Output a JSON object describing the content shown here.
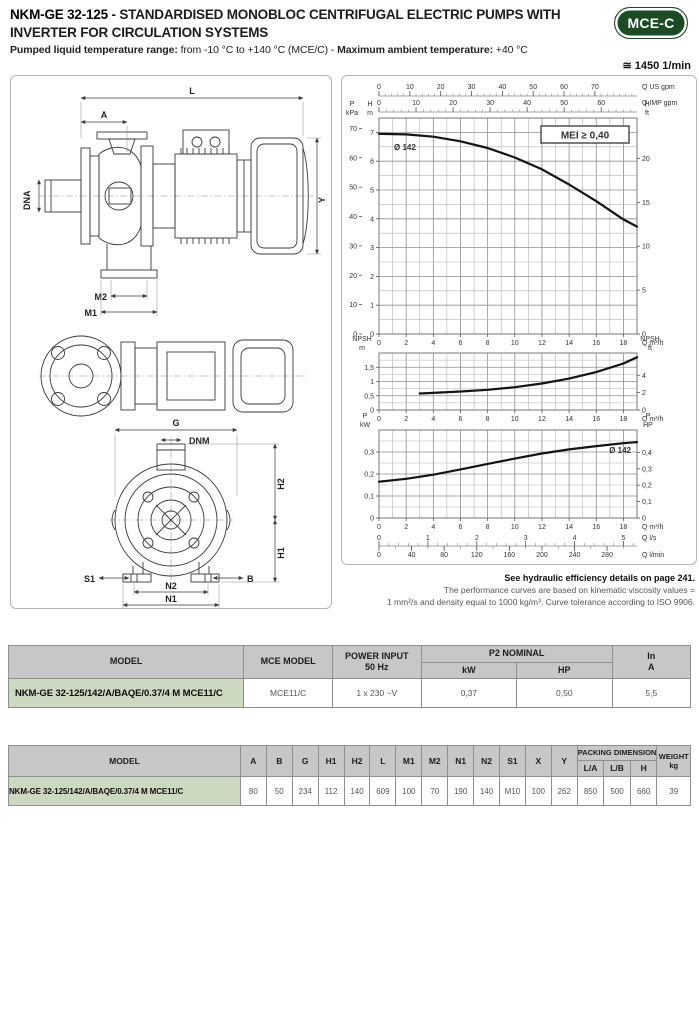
{
  "header": {
    "model": "NKM-GE 32-125",
    "title_sep": " - ",
    "title_rest": "STANDARDISED MONOBLOC CENTRIFUGAL ELECTRIC PUMPS WITH INVERTER FOR CIRCULATION SYSTEMS",
    "badge": "MCE-C",
    "subtitle_bold1": "Pumped liquid temperature range:",
    "subtitle_reg1": " from -10 °C to +140 °C (MCE/C) - ",
    "subtitle_bold2": "Maximum ambient temperature:",
    "subtitle_reg2": " +40 °C",
    "speed": "≅ 1450 1/min"
  },
  "drawing": {
    "labels": {
      "L": "L",
      "A": "A",
      "Y": "Y",
      "DNA": "DNA",
      "M2": "M2",
      "M1": "M1",
      "G": "G",
      "DNM": "DNM",
      "H2": "H2",
      "H1": "H1",
      "S1": "S1",
      "B": "B",
      "N2": "N2",
      "N1": "N1"
    }
  },
  "chart_data": [
    {
      "type": "line",
      "id": "head",
      "badge": "MEI ≥ 0,40",
      "curve_label": "Ø 142",
      "x_axis": {
        "unit": "Q m³/h",
        "min": 0,
        "max": 19,
        "minor_step": 1,
        "major_ticks": [
          0,
          2,
          4,
          6,
          8,
          10,
          12,
          14,
          16,
          18
        ]
      },
      "y_axis": {
        "corner": [
          "H",
          "m"
        ],
        "min": 0,
        "max": 7.5,
        "minor_step": 0.5,
        "major_ticks": [
          0,
          1,
          2,
          3,
          4,
          5,
          6,
          7
        ]
      },
      "left_scale2": {
        "corner": [
          "P",
          "kPa"
        ],
        "ticks": [
          0,
          10,
          20,
          30,
          40,
          50,
          60,
          70
        ],
        "to_primary": 0.10197
      },
      "right_scale": {
        "corner": [
          "H",
          "ft"
        ],
        "ticks": [
          0,
          5,
          10,
          15,
          20
        ],
        "to_primary": 0.3048
      },
      "top_scales": [
        {
          "title": "Q US gpm",
          "ticks": [
            0,
            10,
            20,
            30,
            40,
            50,
            60,
            70
          ],
          "minor_step": 2,
          "to_primary": 0.22712
        },
        {
          "title": "Q IMP gpm",
          "ticks": [
            0,
            10,
            20,
            30,
            40,
            50,
            60
          ],
          "minor_step": 2,
          "to_primary": 0.27276
        }
      ],
      "series": [
        {
          "name": "Ø 142",
          "points": [
            [
              0,
              6.95
            ],
            [
              2,
              6.93
            ],
            [
              4,
              6.85
            ],
            [
              6,
              6.69
            ],
            [
              8,
              6.46
            ],
            [
              10,
              6.13
            ],
            [
              12,
              5.72
            ],
            [
              14,
              5.19
            ],
            [
              16,
              4.61
            ],
            [
              18,
              3.98
            ],
            [
              19,
              3.73
            ]
          ]
        }
      ]
    },
    {
      "type": "line",
      "id": "npsh",
      "x_axis": {
        "unit": "Q m³/h",
        "min": 0,
        "max": 19,
        "minor_step": 1,
        "major_ticks": [
          0,
          2,
          4,
          6,
          8,
          10,
          12,
          14,
          16,
          18
        ]
      },
      "y_axis": {
        "corner": [
          "NPSH",
          "m"
        ],
        "min": 0,
        "max": 2,
        "minor_step": 0.25,
        "major_ticks": [
          0,
          0.5,
          1,
          1.5
        ]
      },
      "right_scale": {
        "corner": [
          "NPSH",
          "ft"
        ],
        "ticks": [
          0,
          2,
          4
        ],
        "to_primary": 0.3048
      },
      "series": [
        {
          "name": "NPSH",
          "points": [
            [
              3,
              0.58
            ],
            [
              4,
              0.6
            ],
            [
              6,
              0.65
            ],
            [
              8,
              0.71
            ],
            [
              10,
              0.8
            ],
            [
              12,
              0.93
            ],
            [
              14,
              1.1
            ],
            [
              16,
              1.33
            ],
            [
              18,
              1.63
            ],
            [
              19,
              1.85
            ]
          ]
        }
      ]
    },
    {
      "type": "line",
      "id": "power",
      "curve_label": "Ø 142",
      "x_axis": {
        "unit": "Q m³/h",
        "min": 0,
        "max": 19,
        "minor_step": 1,
        "major_ticks": [
          0,
          2,
          4,
          6,
          8,
          10,
          12,
          14,
          16,
          18
        ]
      },
      "y_axis": {
        "corner": [
          "P",
          "kW"
        ],
        "min": 0,
        "max": 0.4,
        "minor_step": 0.05,
        "major_ticks": [
          0,
          0.1,
          0.2,
          0.3
        ]
      },
      "right_scale": {
        "corner": [
          "P",
          "HP"
        ],
        "ticks": [
          0,
          0.1,
          0.2,
          0.3,
          0.4
        ],
        "to_primary": 0.7457
      },
      "bottom_scales": [
        {
          "title": "Q l/s",
          "ticks": [
            0,
            1,
            2,
            3,
            4,
            5
          ],
          "minor_step": 0.2,
          "to_primary": 3.6
        },
        {
          "title": "Q l/min",
          "ticks": [
            0,
            40,
            80,
            120,
            160,
            200,
            240,
            280
          ],
          "minor_step": 20,
          "to_primary": 0.06
        }
      ],
      "series": [
        {
          "name": "Ø 142",
          "points": [
            [
              0,
              0.165
            ],
            [
              2,
              0.178
            ],
            [
              4,
              0.197
            ],
            [
              6,
              0.221
            ],
            [
              8,
              0.246
            ],
            [
              10,
              0.27
            ],
            [
              12,
              0.293
            ],
            [
              14,
              0.312
            ],
            [
              16,
              0.327
            ],
            [
              18,
              0.34
            ],
            [
              19,
              0.345
            ]
          ]
        }
      ]
    }
  ],
  "notes": {
    "bold": "See hydraulic efficiency details on page 241.",
    "line1": "The performance curves are based on kinematic viscosity values =",
    "line2": "1 mm²/s and density equal to 1000 kg/m³. Curve tolerance according to ISO 9906."
  },
  "table1": {
    "headers": {
      "model": "MODEL",
      "mce_model": "MCE MODEL",
      "power_input": "POWER INPUT",
      "power_input_sub": "50 Hz",
      "p2_nominal": "P2 NOMINAL",
      "kw": "kW",
      "hp": "HP",
      "in_label": "In",
      "in_sub": "A"
    },
    "row": {
      "model": "NKM-GE 32-125/142/A/BAQE/0.37/4 M MCE11/C",
      "mce_model": "MCE11/C",
      "power_input": "1 x 230 ~V",
      "kw": "0,37",
      "hp": "0,50",
      "in_a": "5,5"
    }
  },
  "table2": {
    "headers": {
      "model": "MODEL",
      "dims": [
        "A",
        "B",
        "G",
        "H1",
        "H2",
        "L",
        "M1",
        "M2",
        "N1",
        "N2",
        "S1",
        "X",
        "Y"
      ],
      "packing": "PACKING DIMENSIONS",
      "packing_sub": [
        "L/A",
        "L/B",
        "H"
      ],
      "weight": "WEIGHT",
      "weight_sub": "kg"
    },
    "row": {
      "model": "NKM-GE 32-125/142/A/BAQE/0.37/4 M MCE11/C",
      "values": [
        "80",
        "50",
        "234",
        "112",
        "140",
        "609",
        "100",
        "70",
        "190",
        "140",
        "M10",
        "100",
        "262"
      ],
      "packing": [
        "850",
        "500",
        "660"
      ],
      "weight": "39"
    }
  },
  "colors": {
    "badge_green": "#1c4a25",
    "model_cell_green": "#cdd8c0",
    "header_gray": "#c7c7c7",
    "curve_black": "#141414"
  }
}
